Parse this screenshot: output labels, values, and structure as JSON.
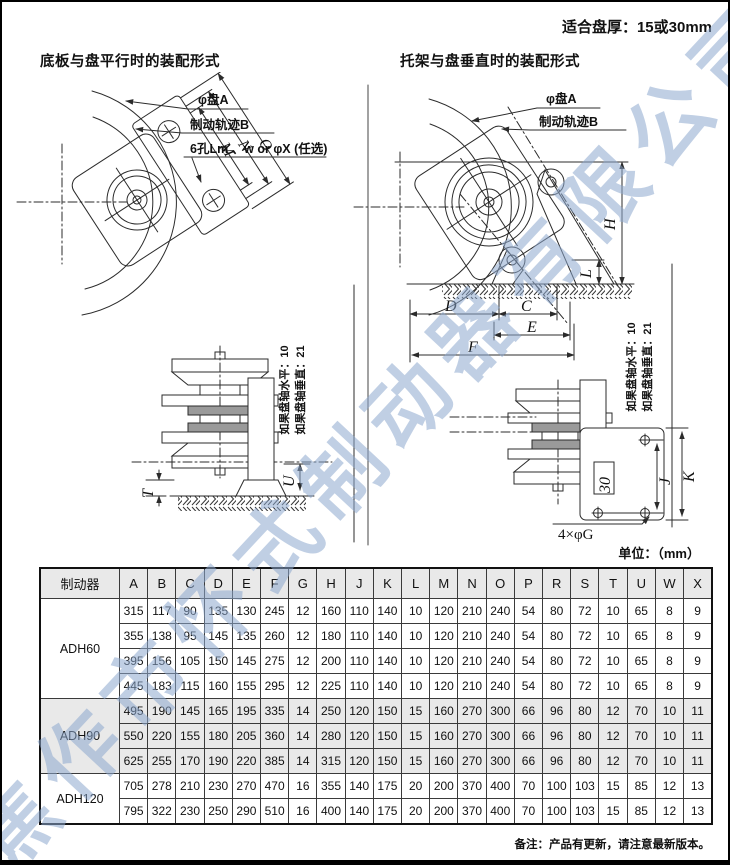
{
  "page": {
    "fit_note": "适合盘厚：15或30mm",
    "units_label": "单位：（mm）",
    "footnote": "备注：产品有更新，请注意最新版本。",
    "watermark": "焦作市怀式制动器有限公司"
  },
  "diagrams": {
    "left": {
      "title": "底板与盘平行时的装配形式",
      "callouts": {
        "disc": "φ盘A",
        "track": "制动轨迹B",
        "holes": "6孔Lm 、w or φX (任选)"
      },
      "dims": {
        "m": "M",
        "n": "N",
        "o": "O"
      }
    },
    "left_side": {
      "dims": {
        "t": "T",
        "u": "U"
      },
      "note1": "如果盘轴水平：10",
      "note2": "如果盘轴垂直：21"
    },
    "right": {
      "title": "托架与盘垂直时的装配形式",
      "callouts": {
        "disc": "φ盘A",
        "track": "制动轨迹B"
      },
      "dims": {
        "h": "H",
        "l": "L",
        "d": "D",
        "c": "C",
        "e": "E",
        "f": "F"
      }
    },
    "right_side": {
      "dims": {
        "thirty": "30",
        "j": "J",
        "k": "K"
      },
      "holes_label": "4×φG",
      "note1": "如果盘轴水平：10",
      "note2": "如果盘轴垂直：21"
    }
  },
  "table": {
    "header": [
      "制动器",
      "A",
      "B",
      "C",
      "D",
      "E",
      "F",
      "G",
      "H",
      "J",
      "K",
      "L",
      "M",
      "N",
      "O",
      "P",
      "R",
      "S",
      "T",
      "U",
      "W",
      "X"
    ],
    "groups": [
      {
        "model": "ADH60",
        "shaded": false,
        "rows": [
          [
            315,
            117,
            90,
            135,
            130,
            245,
            12,
            160,
            110,
            140,
            10,
            120,
            210,
            240,
            54,
            80,
            72,
            10,
            65,
            8,
            9
          ],
          [
            355,
            138,
            95,
            145,
            135,
            260,
            12,
            180,
            110,
            140,
            10,
            120,
            210,
            240,
            54,
            80,
            72,
            10,
            65,
            8,
            9
          ],
          [
            395,
            156,
            105,
            150,
            145,
            275,
            12,
            200,
            110,
            140,
            10,
            120,
            210,
            240,
            54,
            80,
            72,
            10,
            65,
            8,
            9
          ],
          [
            445,
            183,
            115,
            160,
            155,
            295,
            12,
            225,
            110,
            140,
            10,
            120,
            210,
            240,
            54,
            80,
            72,
            10,
            65,
            8,
            9
          ]
        ]
      },
      {
        "model": "ADH90",
        "shaded": true,
        "rows": [
          [
            495,
            190,
            145,
            165,
            195,
            335,
            14,
            250,
            120,
            150,
            15,
            160,
            270,
            300,
            66,
            96,
            80,
            12,
            70,
            10,
            11
          ],
          [
            550,
            220,
            155,
            180,
            205,
            360,
            14,
            280,
            120,
            150,
            15,
            160,
            270,
            300,
            66,
            96,
            80,
            12,
            70,
            10,
            11
          ],
          [
            625,
            255,
            170,
            190,
            220,
            385,
            14,
            315,
            120,
            150,
            15,
            160,
            270,
            300,
            66,
            96,
            80,
            12,
            70,
            10,
            11
          ]
        ]
      },
      {
        "model": "ADH120",
        "shaded": false,
        "rows": [
          [
            705,
            278,
            210,
            230,
            270,
            470,
            16,
            355,
            140,
            175,
            20,
            200,
            370,
            400,
            70,
            100,
            103,
            15,
            85,
            12,
            13
          ],
          [
            795,
            322,
            230,
            250,
            290,
            510,
            16,
            400,
            140,
            175,
            20,
            200,
            370,
            400,
            70,
            100,
            103,
            15,
            85,
            12,
            13
          ]
        ]
      }
    ]
  },
  "colors": {
    "line": "#2b2b2b",
    "watermark": "#8da7ce",
    "shade": "#e9e9e9"
  }
}
